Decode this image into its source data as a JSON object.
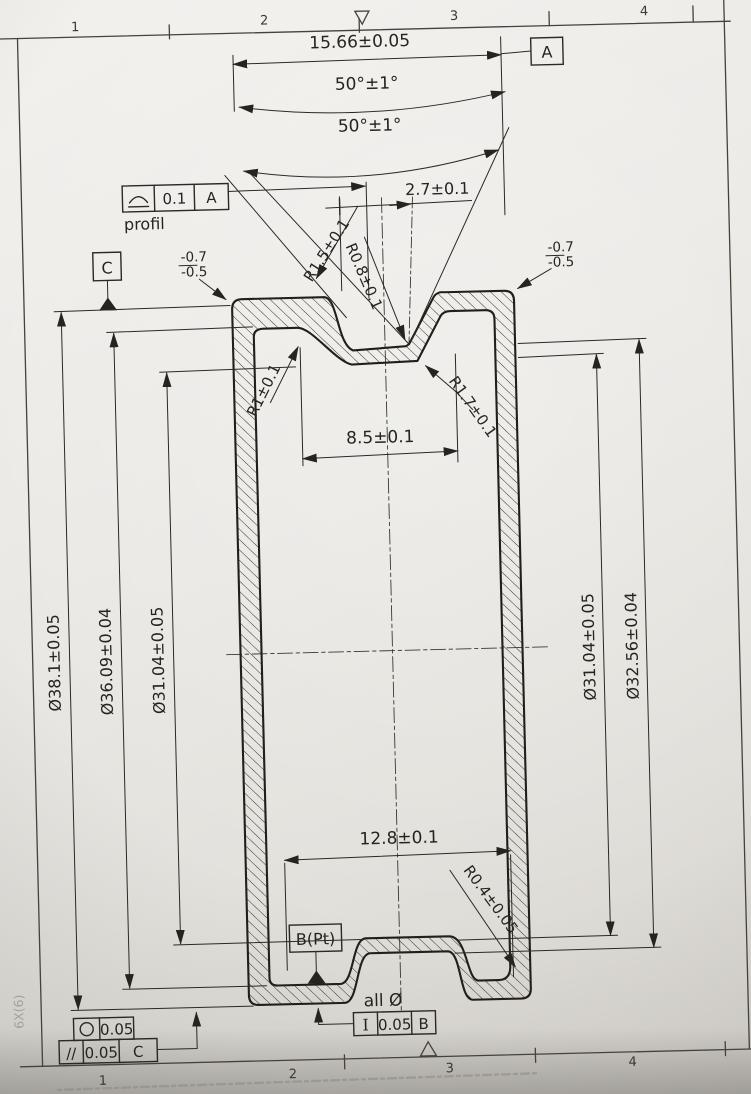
{
  "sheet": {
    "zones_top": [
      "1",
      "2",
      "3",
      "4"
    ],
    "zones_bottom": [
      "1",
      "2",
      "3",
      "4"
    ],
    "edge_note": "6X(6)"
  },
  "dims": {
    "top_width": "15.66±0.05",
    "angle_outer": "50°±1°",
    "angle_inner": "50°±1°",
    "center_offset": "2.7±0.1",
    "radius_flank": "R1.5±0.1",
    "radius_root": "R0.8±0.1",
    "radius_left": "R1±0.1",
    "radius_right": "R1.7±0.1",
    "groove_floor_width": "8.5±0.1",
    "bottom_width": "12.8±0.1",
    "radius_bottom": "R0.4±0.05",
    "edge_left_upper": "-0.7",
    "edge_left_lower": "-0.5",
    "edge_right_upper": "-0.7",
    "edge_right_lower": "-0.5",
    "dia_left": [
      "Ø38.1±0.05",
      "Ø36.09±0.04",
      "Ø31.04±0.05"
    ],
    "dia_right": [
      "Ø31.04±0.05",
      "Ø32.56±0.04"
    ],
    "all_dia_note": "all Ø"
  },
  "datums": {
    "a": "A",
    "b": "B(Pt)",
    "c": "C"
  },
  "fcf": {
    "profile": {
      "tol": "0.1",
      "datum": "A",
      "label": "profil"
    },
    "circularity": {
      "tol": "0.05"
    },
    "parallelism": {
      "sym": "//",
      "tol": "0.05",
      "datum": "C"
    },
    "axial_runout": {
      "sym": "I",
      "tol": "0.05",
      "datum": "B"
    }
  }
}
